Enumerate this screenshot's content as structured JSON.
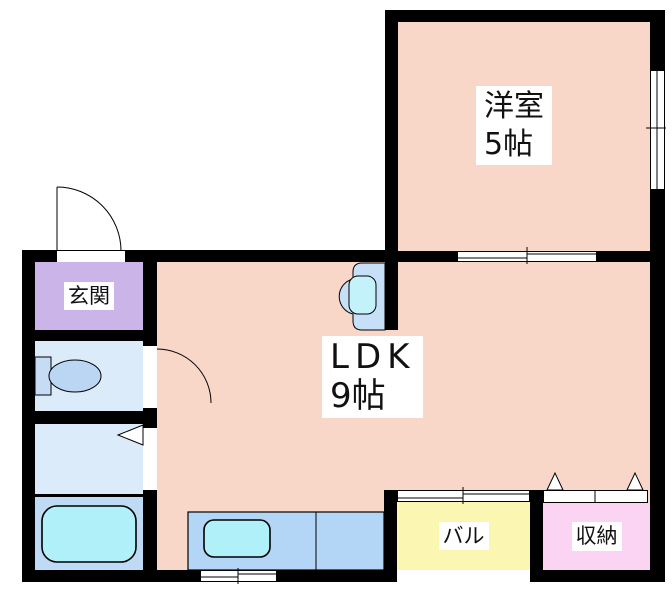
{
  "rooms": {
    "western_room": {
      "label": "洋室",
      "size": "5帖"
    },
    "ldk": {
      "label": "LDK",
      "size": "9帖"
    },
    "entrance": {
      "label": "玄関"
    },
    "balcony": {
      "label": "バル"
    },
    "storage": {
      "label": "収納"
    }
  },
  "colors": {
    "wall": "#000000",
    "room_pink": "#f8d7c8",
    "entrance_purple": "#cbb5e8",
    "wet_room_blue": "#dcebfa",
    "bath_blue": "#bfdaf5",
    "counter_blue": "#b4d6f6",
    "tub_cyan": "#b0f0f8",
    "balcony_yellow": "#fbf7b3",
    "storage_pink": "#fbd3f3"
  }
}
